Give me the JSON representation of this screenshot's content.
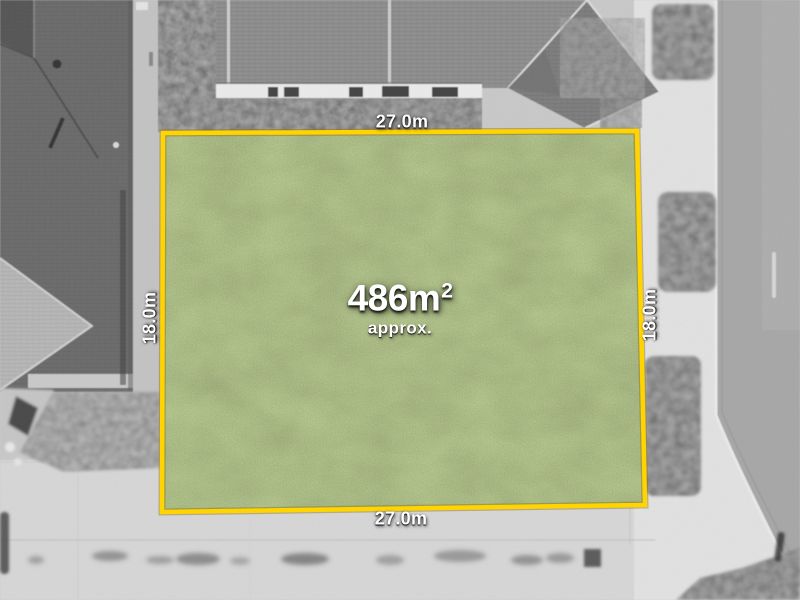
{
  "lot": {
    "area_value": "486m",
    "area_exponent": "2",
    "area_qualifier": "approx.",
    "boundary_color": "#FFD400",
    "grass_color": "#7C9B55",
    "dimensions": {
      "top": "27.0m",
      "bottom": "27.0m",
      "left": "18.0m",
      "right": "18.0m"
    }
  }
}
